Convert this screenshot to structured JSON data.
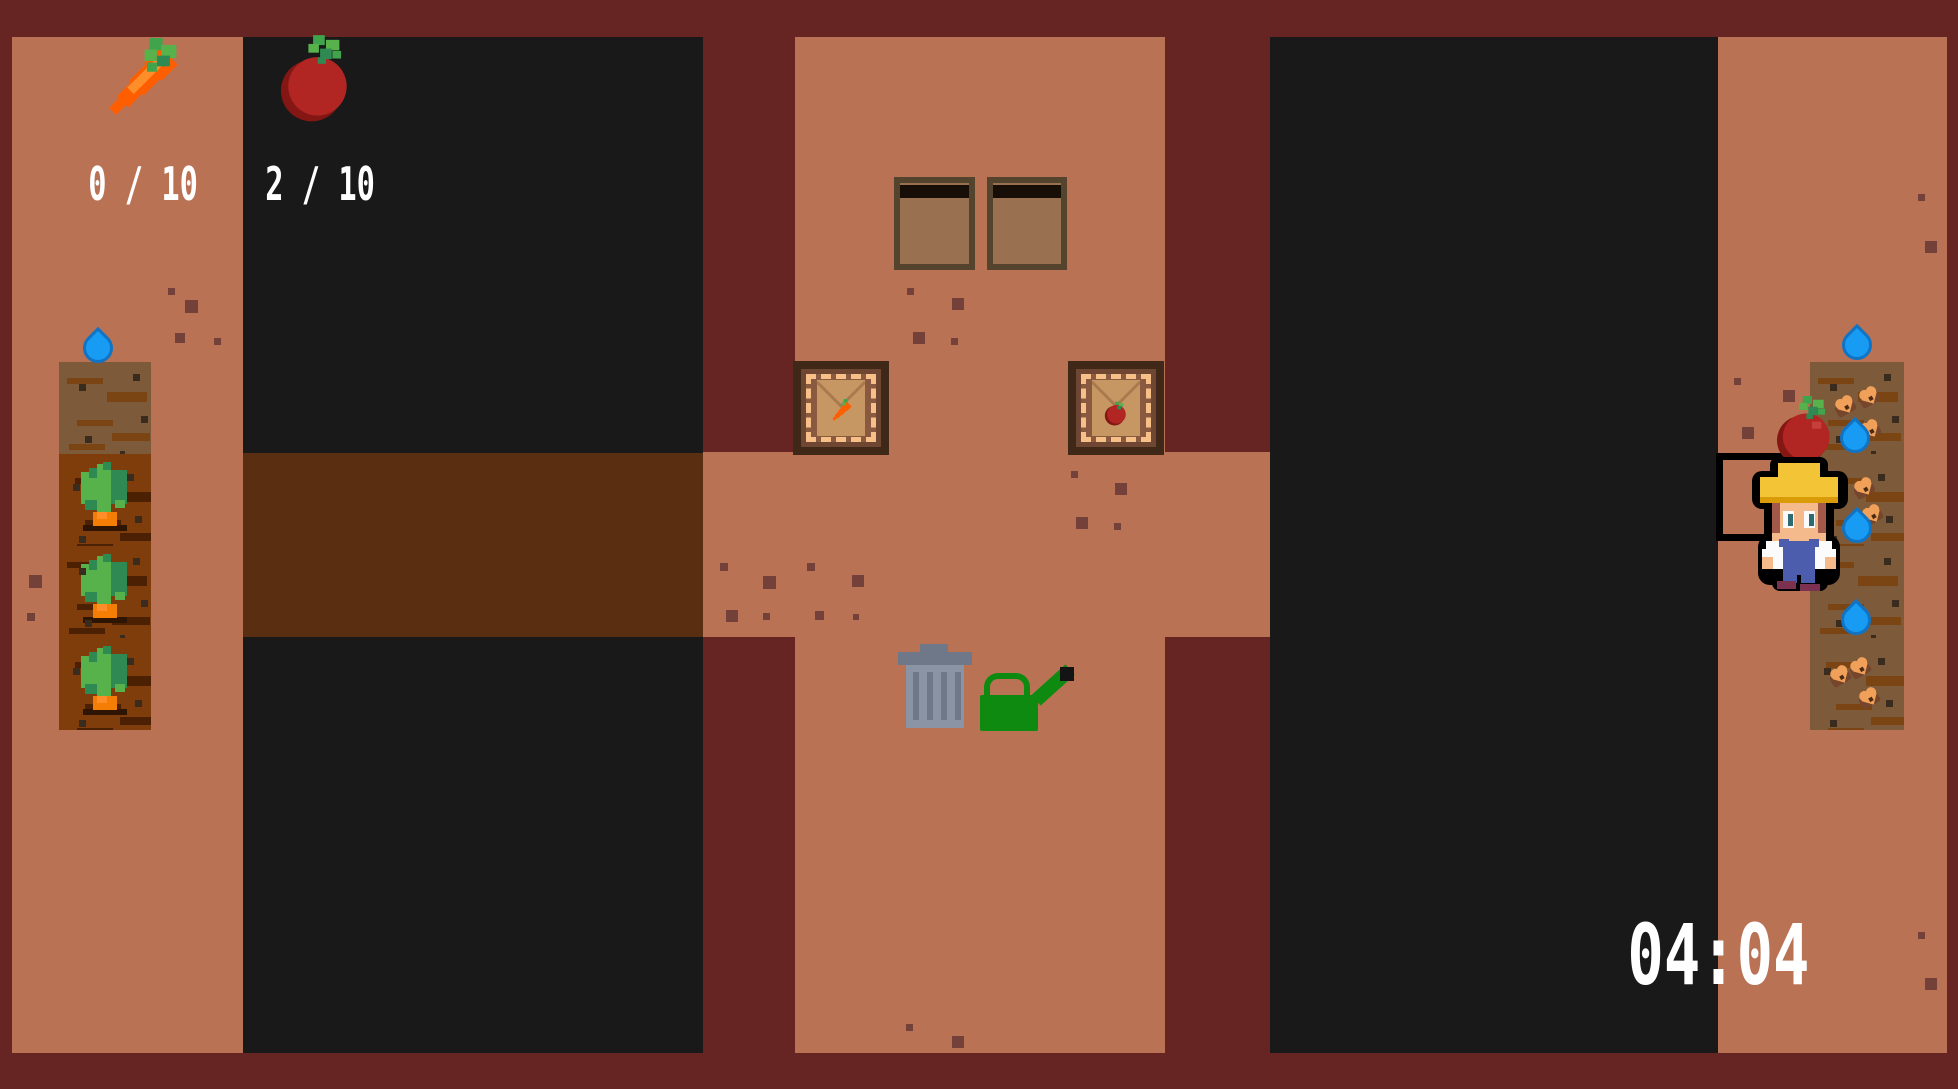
{
  "hud": {
    "carrot_count": "0 / 10",
    "tomato_count": "2 / 10",
    "timer": "04:04",
    "carrot_icon": "carrot-icon",
    "tomato_icon": "tomato-icon"
  },
  "palette": {
    "maroon": "#662523",
    "tan": "#ba7254",
    "voidc": "#191919",
    "corridorBrown": "#5a2e10",
    "drySoil": "#7d5a3a",
    "dryStreak": "#7a4413",
    "richSoil": "#7e3d0b",
    "richStreak": "#4b2003",
    "soilSpeck": "#3a2b1f",
    "groundSpeck": "#74413a",
    "waterFill": "#189bf2",
    "waterEdge": "#1173c4",
    "leafLight": "#57b24c",
    "leafMid": "#3fa44c",
    "leafDark": "#2e8a52",
    "rootOrange": "#f47d05",
    "rootShadow": "#2e1503",
    "carrotOrange": "#fe5e00",
    "carrotLight": "#ff8e2a",
    "tomatoRed": "#b12522",
    "tomatoDark": "#841714",
    "tomatoHighlight": "#c63f38",
    "hudText": "#ffffff",
    "crateBorder": "#54432d",
    "crateFill": "#997150",
    "crateStrip": "#170e08",
    "boxOuter": "#3f2817",
    "boxFrame": "#6f4631",
    "boxInner": "#8a5a40",
    "boxDash": "#f6c088",
    "envelope": "#c79763",
    "envelopeFlap": "#a87a4e",
    "trashLid": "#6e7889",
    "trashBody": "#8b94a5",
    "canGreen": "#0e8a10",
    "canTip": "#141414",
    "farmerHat": "#f3c435",
    "farmerHatShade": "#d99b07",
    "skin": "#f5ba8c",
    "hair": "#a3594a",
    "iris": "#2d6b72",
    "shirt": "#fbfbfb",
    "overalls": "#4c5dad",
    "shoes": "#7d3150",
    "seedBrown": "#75452c",
    "seedOrange": "#f0a058"
  },
  "entities": {
    "left_plot": {
      "x": 59,
      "y": 362,
      "w": 92,
      "tile_h": 92,
      "tiles": [
        "dry",
        "carrot",
        "carrot",
        "carrot"
      ]
    },
    "right_plot": {
      "x": 1810,
      "y": 362,
      "w": 94,
      "tile_h": 92,
      "tiles": [
        "seeded",
        "seeded",
        "seeded",
        "seeded"
      ]
    },
    "droplets": [
      {
        "x": 83,
        "y": 333
      },
      {
        "x": 1842,
        "y": 330
      },
      {
        "x": 1840,
        "y": 423
      },
      {
        "x": 1842,
        "y": 513
      },
      {
        "x": 1841,
        "y": 605
      }
    ],
    "seeds": [
      {
        "x": 1830,
        "y": 390
      },
      {
        "x": 1854,
        "y": 381
      },
      {
        "x": 1855,
        "y": 414
      },
      {
        "x": 1849,
        "y": 472
      },
      {
        "x": 1857,
        "y": 499
      },
      {
        "x": 1825,
        "y": 660
      },
      {
        "x": 1845,
        "y": 652
      },
      {
        "x": 1854,
        "y": 682
      }
    ],
    "ground_specks": [
      {
        "x": 168,
        "y": 288,
        "s": 7
      },
      {
        "x": 185,
        "y": 300,
        "s": 13
      },
      {
        "x": 175,
        "y": 333,
        "s": 10
      },
      {
        "x": 214,
        "y": 338,
        "s": 7
      },
      {
        "x": 29,
        "y": 575,
        "s": 13
      },
      {
        "x": 27,
        "y": 613,
        "s": 8
      },
      {
        "x": 907,
        "y": 288,
        "s": 7
      },
      {
        "x": 952,
        "y": 298,
        "s": 12
      },
      {
        "x": 913,
        "y": 332,
        "s": 12
      },
      {
        "x": 951,
        "y": 338,
        "s": 7
      },
      {
        "x": 720,
        "y": 563,
        "s": 8
      },
      {
        "x": 763,
        "y": 576,
        "s": 13
      },
      {
        "x": 807,
        "y": 563,
        "s": 8
      },
      {
        "x": 852,
        "y": 575,
        "s": 12
      },
      {
        "x": 726,
        "y": 610,
        "s": 12
      },
      {
        "x": 763,
        "y": 613,
        "s": 7
      },
      {
        "x": 815,
        "y": 611,
        "s": 9
      },
      {
        "x": 853,
        "y": 614,
        "s": 6
      },
      {
        "x": 1071,
        "y": 471,
        "s": 7
      },
      {
        "x": 1115,
        "y": 483,
        "s": 12
      },
      {
        "x": 1076,
        "y": 517,
        "s": 12
      },
      {
        "x": 1114,
        "y": 523,
        "s": 7
      },
      {
        "x": 906,
        "y": 1024,
        "s": 7
      },
      {
        "x": 952,
        "y": 1036,
        "s": 12
      },
      {
        "x": 1734,
        "y": 378,
        "s": 7
      },
      {
        "x": 1783,
        "y": 390,
        "s": 12
      },
      {
        "x": 1742,
        "y": 427,
        "s": 12
      },
      {
        "x": 1918,
        "y": 194,
        "s": 7
      },
      {
        "x": 1925,
        "y": 241,
        "s": 12
      },
      {
        "x": 1918,
        "y": 932,
        "s": 7
      },
      {
        "x": 1925,
        "y": 978,
        "s": 12
      }
    ]
  }
}
